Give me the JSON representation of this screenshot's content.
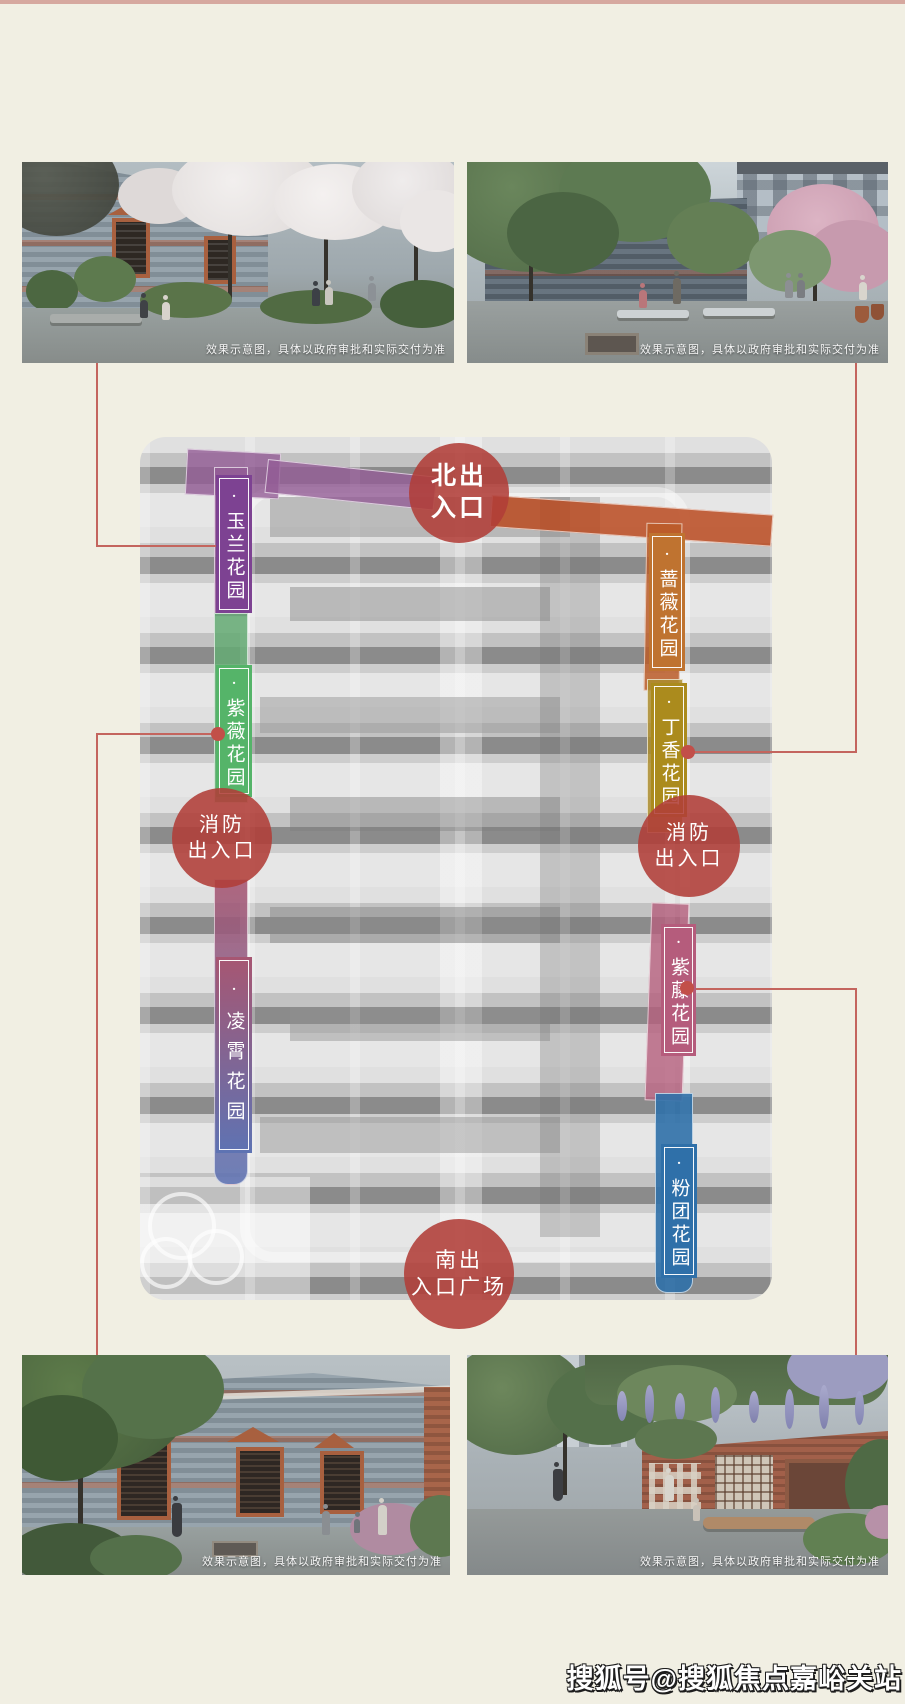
{
  "page": {
    "width": 905,
    "height": 1704,
    "background": "#f1efe3",
    "top_border_color": "#d6a89f"
  },
  "photos": {
    "caption": "效果示意图，具体以政府审批和实际交付为准",
    "items": [
      {
        "id": "top-left",
        "alt": "lane with white blossom trees beside grey brick houses"
      },
      {
        "id": "top-right",
        "alt": "courtyard garden with benches, trees and pink blossoms"
      },
      {
        "id": "bottom-left",
        "alt": "grey brick facade with red brick window frames and garden path"
      },
      {
        "id": "bottom-right",
        "alt": "wisteria courtyard with red brick wall and bench"
      }
    ]
  },
  "map": {
    "entrance_circle_color": "rgba(177,62,56,0.88)",
    "north_path_color": "rgba(186,74,32,0.85)",
    "connector_color": "#c4655e",
    "dot_color": "#c24f49",
    "entrances": [
      {
        "id": "north",
        "lines": [
          "北出",
          "入口"
        ]
      },
      {
        "id": "fire-west",
        "lines": [
          "消防",
          "出入口"
        ]
      },
      {
        "id": "fire-east",
        "lines": [
          "消防",
          "出入口"
        ]
      },
      {
        "id": "south-plaza",
        "lines": [
          "南出",
          "入口广场"
        ]
      }
    ],
    "gardens": [
      {
        "id": "yulan",
        "label": "·玉兰花园",
        "color": "#7d4292",
        "strip_color": "rgba(148,92,150,0.8)"
      },
      {
        "id": "ziwei",
        "label": "·紫薇花园",
        "color": "#55b469",
        "strip_color": "rgba(100,170,115,0.85)"
      },
      {
        "id": "lingxiao",
        "label": "·凌霄花园",
        "color_top": "#a75672",
        "color_bottom": "#5e73b3"
      },
      {
        "id": "qiangwei",
        "label": "·蔷薇花园",
        "color": "#bf7330",
        "strip_color": "rgba(187,92,40,0.85)"
      },
      {
        "id": "dingxiang",
        "label": "·丁香花园",
        "color": "#ab8b1d",
        "strip_color": "rgba(172,140,45,0.85)"
      },
      {
        "id": "ziteng",
        "label": "·紫藤花园",
        "color": "#b55c7c",
        "strip_color": "rgba(181,95,125,0.8)"
      },
      {
        "id": "fentuan",
        "label": "·粉团花园",
        "color": "#2f70a9",
        "strip_color": "rgba(47,112,169,0.9)"
      }
    ]
  },
  "watermark": "搜狐号@搜狐焦点嘉峪关站"
}
